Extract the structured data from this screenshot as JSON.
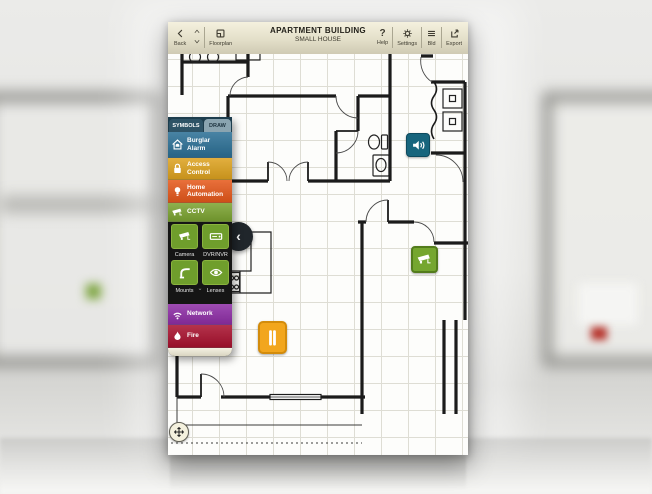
{
  "toolbar": {
    "back": "Back",
    "floorplan": "Floorplan",
    "title": "APARTMENT BUILDING",
    "subtitle": "SMALL HOUSE",
    "help": "Help",
    "help_icon": "?",
    "settings": "Settings",
    "bld": "Bld",
    "export": "Export"
  },
  "sidebar": {
    "tabs": [
      {
        "label": "SYMBOLS",
        "selected": true
      },
      {
        "label": "DRAW",
        "selected": false
      }
    ],
    "categories": [
      {
        "label": "Burglar Alarm",
        "color": "#2b6f95",
        "icon": "house-bell-icon"
      },
      {
        "label": "Access Control",
        "color": "#dda21f",
        "icon": "padlock-icon"
      },
      {
        "label": "Home Automation",
        "color": "#e5581b",
        "icon": "bulb-icon"
      },
      {
        "label": "CCTV",
        "color": "#7ba331",
        "icon": "cctv-camera-icon",
        "expanded": true
      },
      {
        "label": "Network",
        "color": "#8e2ea6",
        "icon": "wifi-icon"
      },
      {
        "label": "Fire",
        "color": "#a8112e",
        "icon": "flame-icon"
      }
    ],
    "cctv_tiles": [
      {
        "label": "Camera",
        "icon": "cctv-camera-icon"
      },
      {
        "label": "DVR/NVR",
        "icon": "recorder-icon"
      },
      {
        "label": "Mounts",
        "icon": "mount-arm-icon"
      },
      {
        "label": "Lenses",
        "icon": "eye-icon"
      }
    ],
    "tile_color": "#6f9e2c"
  },
  "plan": {
    "devices": [
      {
        "name": "sounder",
        "color": "#17657d"
      },
      {
        "name": "cctv-camera",
        "color": "#75a62f"
      },
      {
        "name": "door-contact",
        "color": "#f2a61d"
      }
    ]
  },
  "icons": {
    "collapse": "‹",
    "tiles_chevron": "⌄"
  }
}
